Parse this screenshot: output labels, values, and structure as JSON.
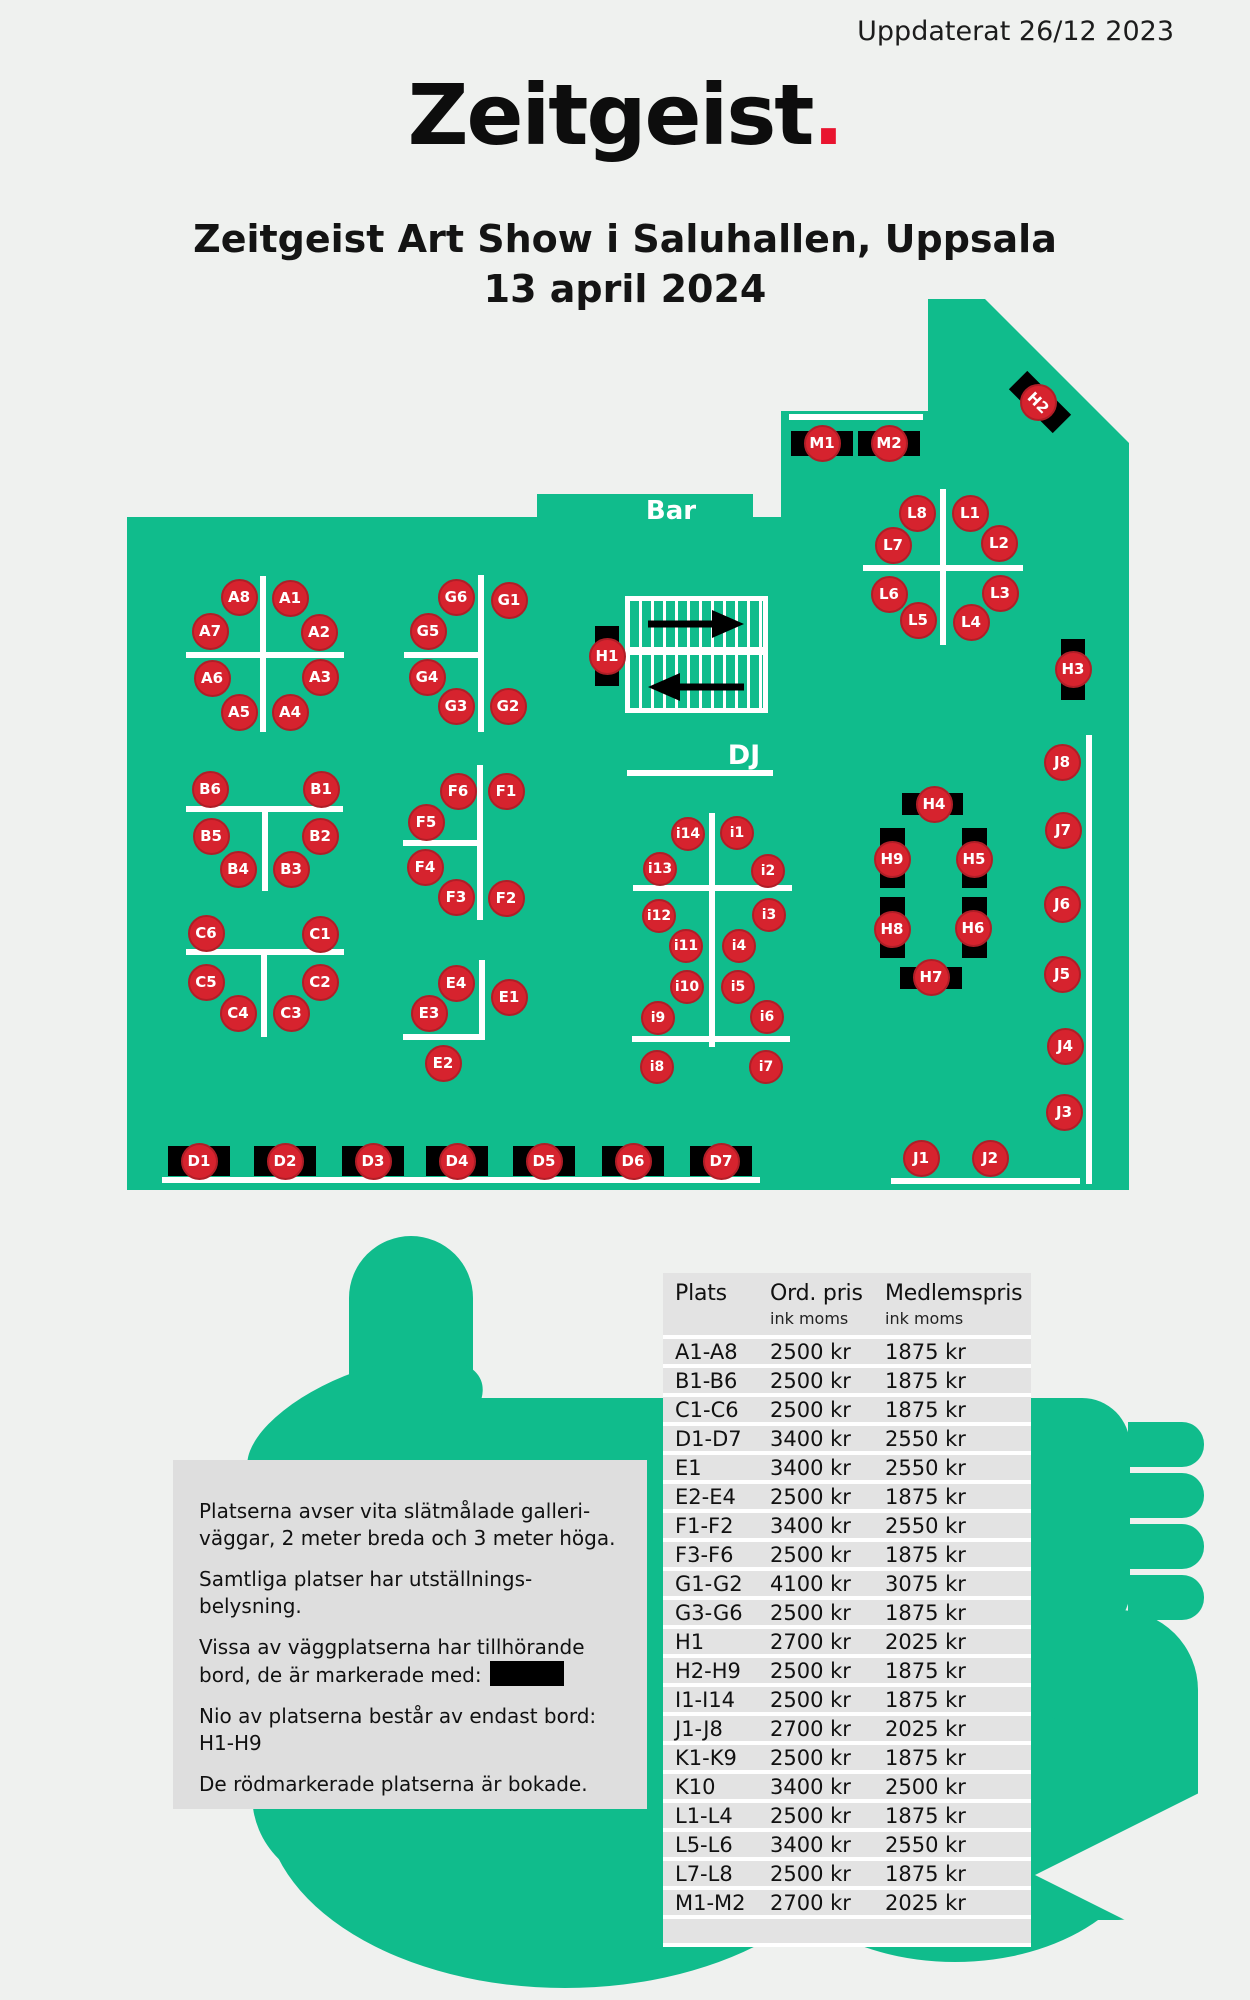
{
  "header": {
    "updated": "Uppdaterat 26/12 2023",
    "logo": "Zeitgeist",
    "logo_dot": ".",
    "title_line1": "Zeitgeist Art Show i Saluhallen, Uppsala",
    "title_line2": "13 april 2024"
  },
  "colors": {
    "page_bg": "#eff1ef",
    "floor_green": "#10bc8c",
    "seat_red": "#d6232e",
    "seat_border": "#b01e27",
    "logo_dot_red": "#e9142f",
    "table_black": "#000000",
    "panel_gray": "#dedede",
    "row_gray": "#e3e3e3"
  },
  "floor": {
    "labels": {
      "bar": "Bar",
      "dj": "DJ"
    },
    "outline_points": "127,517 537,517 537,494 753,494 753,517 781,517 781,411 928,411 928,299 985,299 1129,443 1129,1190 127,1190",
    "seats": [
      {
        "id": "A8",
        "x": 239,
        "y": 597
      },
      {
        "id": "A1",
        "x": 290,
        "y": 598
      },
      {
        "id": "A7",
        "x": 210,
        "y": 631
      },
      {
        "id": "A2",
        "x": 319,
        "y": 632
      },
      {
        "id": "A6",
        "x": 212,
        "y": 678
      },
      {
        "id": "A3",
        "x": 320,
        "y": 677
      },
      {
        "id": "A5",
        "x": 239,
        "y": 712
      },
      {
        "id": "A4",
        "x": 290,
        "y": 712
      },
      {
        "id": "G6",
        "x": 456,
        "y": 597
      },
      {
        "id": "G1",
        "x": 509,
        "y": 600
      },
      {
        "id": "G5",
        "x": 428,
        "y": 631
      },
      {
        "id": "G4",
        "x": 427,
        "y": 677
      },
      {
        "id": "G3",
        "x": 456,
        "y": 706
      },
      {
        "id": "G2",
        "x": 508,
        "y": 706
      },
      {
        "id": "B6",
        "x": 210,
        "y": 789
      },
      {
        "id": "B1",
        "x": 321,
        "y": 789
      },
      {
        "id": "B5",
        "x": 211,
        "y": 836
      },
      {
        "id": "B2",
        "x": 320,
        "y": 836
      },
      {
        "id": "B4",
        "x": 238,
        "y": 869
      },
      {
        "id": "B3",
        "x": 291,
        "y": 869
      },
      {
        "id": "C6",
        "x": 206,
        "y": 933
      },
      {
        "id": "C1",
        "x": 320,
        "y": 934
      },
      {
        "id": "C5",
        "x": 206,
        "y": 982
      },
      {
        "id": "C2",
        "x": 320,
        "y": 982
      },
      {
        "id": "C4",
        "x": 238,
        "y": 1013
      },
      {
        "id": "C3",
        "x": 291,
        "y": 1013
      },
      {
        "id": "F6",
        "x": 458,
        "y": 791
      },
      {
        "id": "F1",
        "x": 506,
        "y": 791
      },
      {
        "id": "F5",
        "x": 426,
        "y": 822
      },
      {
        "id": "F4",
        "x": 425,
        "y": 867
      },
      {
        "id": "F3",
        "x": 456,
        "y": 897
      },
      {
        "id": "F2",
        "x": 506,
        "y": 898
      },
      {
        "id": "E4",
        "x": 456,
        "y": 983
      },
      {
        "id": "E1",
        "x": 509,
        "y": 997
      },
      {
        "id": "E3",
        "x": 429,
        "y": 1013
      },
      {
        "id": "E2",
        "x": 443,
        "y": 1063
      },
      {
        "id": "i14",
        "x": 688,
        "y": 834,
        "sm": 1
      },
      {
        "id": "i1",
        "x": 737,
        "y": 833,
        "sm": 1
      },
      {
        "id": "i13",
        "x": 660,
        "y": 869,
        "sm": 1
      },
      {
        "id": "i2",
        "x": 768,
        "y": 871,
        "sm": 1
      },
      {
        "id": "i12",
        "x": 659,
        "y": 916,
        "sm": 1
      },
      {
        "id": "i3",
        "x": 769,
        "y": 915,
        "sm": 1
      },
      {
        "id": "i11",
        "x": 686,
        "y": 946,
        "sm": 1
      },
      {
        "id": "i4",
        "x": 739,
        "y": 946,
        "sm": 1
      },
      {
        "id": "i10",
        "x": 687,
        "y": 987,
        "sm": 1
      },
      {
        "id": "i5",
        "x": 738,
        "y": 987,
        "sm": 1
      },
      {
        "id": "i9",
        "x": 658,
        "y": 1018,
        "sm": 1
      },
      {
        "id": "i6",
        "x": 767,
        "y": 1017,
        "sm": 1
      },
      {
        "id": "i8",
        "x": 657,
        "y": 1067,
        "sm": 1
      },
      {
        "id": "i7",
        "x": 766,
        "y": 1067,
        "sm": 1
      },
      {
        "id": "L8",
        "x": 917,
        "y": 513
      },
      {
        "id": "L1",
        "x": 970,
        "y": 513
      },
      {
        "id": "L7",
        "x": 893,
        "y": 545
      },
      {
        "id": "L2",
        "x": 999,
        "y": 543
      },
      {
        "id": "L6",
        "x": 889,
        "y": 594
      },
      {
        "id": "L3",
        "x": 1000,
        "y": 593
      },
      {
        "id": "L5",
        "x": 918,
        "y": 620
      },
      {
        "id": "L4",
        "x": 971,
        "y": 622
      },
      {
        "id": "J8",
        "x": 1062,
        "y": 762
      },
      {
        "id": "J7",
        "x": 1063,
        "y": 830
      },
      {
        "id": "J6",
        "x": 1062,
        "y": 904
      },
      {
        "id": "J5",
        "x": 1062,
        "y": 974
      },
      {
        "id": "J4",
        "x": 1065,
        "y": 1046
      },
      {
        "id": "J3",
        "x": 1064,
        "y": 1112
      },
      {
        "id": "J1",
        "x": 921,
        "y": 1158
      },
      {
        "id": "J2",
        "x": 990,
        "y": 1158
      },
      {
        "id": "M1",
        "x": 822,
        "y": 443
      },
      {
        "id": "M2",
        "x": 889,
        "y": 443
      },
      {
        "id": "H2",
        "x": 1038,
        "y": 402,
        "rot": 45
      },
      {
        "id": "H1",
        "x": 607,
        "y": 656
      },
      {
        "id": "H3",
        "x": 1073,
        "y": 669
      },
      {
        "id": "H4",
        "x": 934,
        "y": 804
      },
      {
        "id": "H9",
        "x": 892,
        "y": 859
      },
      {
        "id": "H5",
        "x": 974,
        "y": 859
      },
      {
        "id": "H8",
        "x": 892,
        "y": 929
      },
      {
        "id": "H6",
        "x": 973,
        "y": 928
      },
      {
        "id": "H7",
        "x": 931,
        "y": 977
      },
      {
        "id": "D1",
        "x": 199,
        "y": 1161
      },
      {
        "id": "D2",
        "x": 285,
        "y": 1161
      },
      {
        "id": "D3",
        "x": 373,
        "y": 1161
      },
      {
        "id": "D4",
        "x": 457,
        "y": 1161
      },
      {
        "id": "D5",
        "x": 544,
        "y": 1161
      },
      {
        "id": "D6",
        "x": 633,
        "y": 1161
      },
      {
        "id": "D7",
        "x": 721,
        "y": 1161
      }
    ],
    "tables": [
      {
        "x": 791,
        "y": 431,
        "w": 62,
        "h": 25
      },
      {
        "x": 858,
        "y": 431,
        "w": 62,
        "h": 25
      },
      {
        "x": 1009,
        "y": 389,
        "w": 62,
        "h": 26,
        "rot": 45
      },
      {
        "x": 595,
        "y": 626,
        "w": 24,
        "h": 60
      },
      {
        "x": 1061,
        "y": 639,
        "w": 24,
        "h": 61
      },
      {
        "x": 902,
        "y": 793,
        "w": 61,
        "h": 22
      },
      {
        "x": 900,
        "y": 967,
        "w": 62,
        "h": 22
      },
      {
        "x": 880,
        "y": 828,
        "w": 25,
        "h": 60
      },
      {
        "x": 962,
        "y": 828,
        "w": 25,
        "h": 60
      },
      {
        "x": 880,
        "y": 897,
        "w": 25,
        "h": 61
      },
      {
        "x": 962,
        "y": 897,
        "w": 25,
        "h": 61
      },
      {
        "x": 168,
        "y": 1146,
        "w": 62,
        "h": 30
      },
      {
        "x": 254,
        "y": 1146,
        "w": 62,
        "h": 30
      },
      {
        "x": 342,
        "y": 1146,
        "w": 62,
        "h": 30
      },
      {
        "x": 426,
        "y": 1146,
        "w": 62,
        "h": 30
      },
      {
        "x": 513,
        "y": 1146,
        "w": 62,
        "h": 30
      },
      {
        "x": 602,
        "y": 1146,
        "w": 62,
        "h": 30
      },
      {
        "x": 690,
        "y": 1146,
        "w": 62,
        "h": 30
      }
    ],
    "walls": [
      {
        "x": 789,
        "y": 414,
        "w": 134,
        "h": 6
      },
      {
        "x": 260,
        "y": 576,
        "w": 6,
        "h": 156
      },
      {
        "x": 186,
        "y": 652,
        "w": 158,
        "h": 6
      },
      {
        "x": 478,
        "y": 575,
        "w": 6,
        "h": 157
      },
      {
        "x": 404,
        "y": 652,
        "w": 77,
        "h": 6
      },
      {
        "x": 186,
        "y": 806,
        "w": 157,
        "h": 6
      },
      {
        "x": 262,
        "y": 809,
        "w": 6,
        "h": 82
      },
      {
        "x": 186,
        "y": 949,
        "w": 158,
        "h": 6
      },
      {
        "x": 261,
        "y": 952,
        "w": 6,
        "h": 85
      },
      {
        "x": 477,
        "y": 765,
        "w": 6,
        "h": 155
      },
      {
        "x": 403,
        "y": 840,
        "w": 77,
        "h": 6
      },
      {
        "x": 479,
        "y": 960,
        "w": 6,
        "h": 80
      },
      {
        "x": 403,
        "y": 1034,
        "w": 82,
        "h": 6
      },
      {
        "x": 709,
        "y": 813,
        "w": 6,
        "h": 234
      },
      {
        "x": 633,
        "y": 885,
        "w": 159,
        "h": 6
      },
      {
        "x": 632,
        "y": 1036,
        "w": 158,
        "h": 6
      },
      {
        "x": 940,
        "y": 489,
        "w": 6,
        "h": 156
      },
      {
        "x": 863,
        "y": 565,
        "w": 160,
        "h": 6
      },
      {
        "x": 627,
        "y": 770,
        "w": 146,
        "h": 6
      },
      {
        "x": 162,
        "y": 1177,
        "w": 598,
        "h": 6
      },
      {
        "x": 891,
        "y": 1178,
        "w": 189,
        "h": 6
      },
      {
        "x": 1086,
        "y": 735,
        "w": 6,
        "h": 449
      }
    ]
  },
  "legend": {
    "p1": "Platserna avser vita slätmålade galleri-\nväggar, 2 meter breda och 3 meter höga.",
    "p2": "Samtliga platser har utställnings-\nbelysning.",
    "p3": "Vissa av väggplatserna har tillhörande\nbord, de är markerade med:",
    "p4": "Nio av platserna består av endast bord:\nH1-H9",
    "p5": "De rödmarkerade platserna är bokade."
  },
  "pricing": {
    "col_plats": "Plats",
    "col_ord": "Ord. pris",
    "col_medlem": "Medlemspris",
    "col_sub": "ink moms",
    "rows": [
      [
        "A1-A8",
        "2500 kr",
        "1875 kr"
      ],
      [
        "B1-B6",
        "2500 kr",
        "1875 kr"
      ],
      [
        "C1-C6",
        "2500 kr",
        "1875 kr"
      ],
      [
        "D1-D7",
        "3400 kr",
        "2550 kr"
      ],
      [
        "E1",
        "3400 kr",
        "2550 kr"
      ],
      [
        "E2-E4",
        "2500 kr",
        "1875 kr"
      ],
      [
        "F1-F2",
        "3400 kr",
        "2550 kr"
      ],
      [
        "F3-F6",
        "2500 kr",
        "1875 kr"
      ],
      [
        "G1-G2",
        "4100 kr",
        "3075 kr"
      ],
      [
        "G3-G6",
        "2500 kr",
        "1875 kr"
      ],
      [
        "H1",
        "2700 kr",
        "2025 kr"
      ],
      [
        "H2-H9",
        "2500 kr",
        "1875 kr"
      ],
      [
        "I1-I14",
        "2500 kr",
        "1875 kr"
      ],
      [
        "J1-J8",
        "2700 kr",
        "2025 kr"
      ],
      [
        "K1-K9",
        "2500 kr",
        "1875 kr"
      ],
      [
        "K10",
        "3400 kr",
        "2500 kr"
      ],
      [
        "L1-L4",
        "2500 kr",
        "1875 kr"
      ],
      [
        "L5-L6",
        "3400 kr",
        "2550 kr"
      ],
      [
        "L7-L8",
        "2500 kr",
        "1875 kr"
      ],
      [
        "M1-M2",
        "2700 kr",
        "2025 kr"
      ]
    ]
  }
}
